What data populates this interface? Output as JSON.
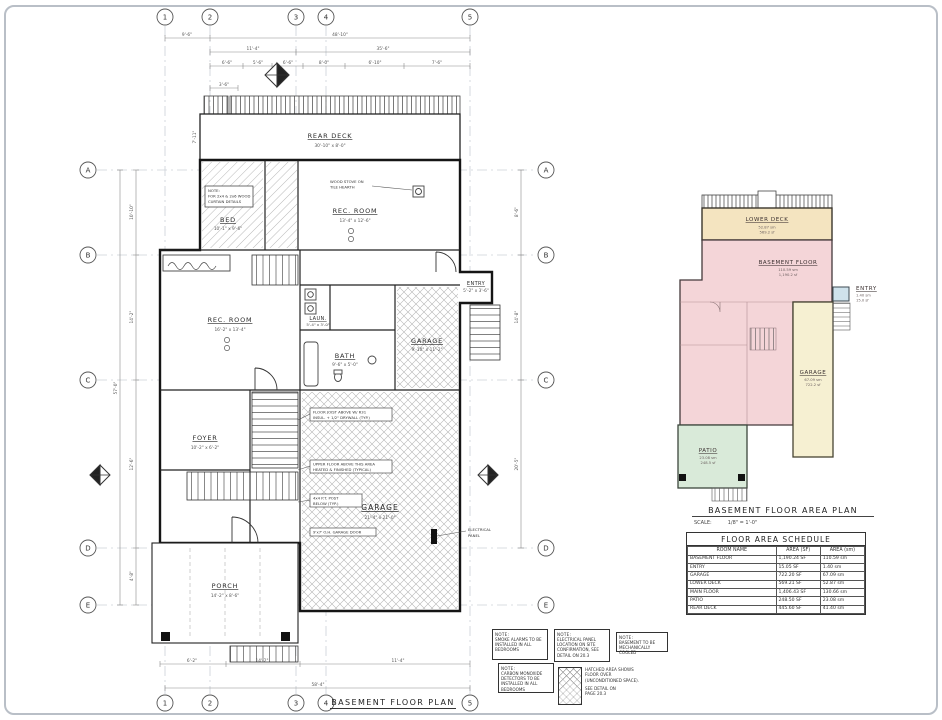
{
  "sheet": {
    "main_title": "BASEMENT FLOOR PLAN",
    "grid_cols": [
      "1",
      "2",
      "3",
      "4",
      "5"
    ],
    "grid_rows": [
      "A",
      "B",
      "C",
      "D",
      "E"
    ]
  },
  "dims": {
    "top1a": "9'-6\"",
    "top1b": "48'-10\"",
    "top2a": "11'-4\"",
    "top2b": "35'-6\"",
    "top3": [
      "6'-6\"",
      "5'-6\"",
      "6'-6\"",
      "8'-0\"",
      "6'-10\"",
      "7'-6\""
    ],
    "small_top": "3'-6\"",
    "deck_left": "7'-11\"",
    "left_overall": "57'-0\"",
    "left_segs": [
      "10'-10\"",
      "14'-2\"",
      "12'-6\"",
      "4'-8\""
    ],
    "right_segs": [
      "8'-6\"",
      "14'-8\"",
      "20'-5\""
    ],
    "bottom_segs": [
      "6'-2\"",
      "14'-2\"",
      "11'-4\""
    ],
    "bottom_overall": "58'-4\""
  },
  "rooms": {
    "rear_deck": {
      "name": "REAR DECK",
      "dim": "30'-10\" x 8'-0\""
    },
    "bed": {
      "name": "BED",
      "dim": "10'-1\" x 9'-6\""
    },
    "rec_upper": {
      "name": "REC. ROOM",
      "dim": "13'-4\" x 12'-6\""
    },
    "rec_lower": {
      "name": "REC. ROOM",
      "dim": "16'-2\" x 13'-4\""
    },
    "garage_upper": {
      "name": "GARAGE",
      "dim": "9'-10\" x 11'-2\""
    },
    "entry": {
      "name": "ENTRY",
      "dim": "5'-2\" x 3'-6\""
    },
    "laundry": {
      "name": "LAUN.",
      "dim": "5'-4\" x 3'-0\""
    },
    "bath": {
      "name": "BATH",
      "dim": "9'-6\" x 5'-0\""
    },
    "foyer": {
      "name": "FOYER",
      "dim": "10'-2\" x 6'-2\""
    },
    "garage_lower": {
      "name": "GARAGE",
      "dim": "21'-4\" x 21'-0\""
    },
    "porch": {
      "name": "PORCH",
      "dim": "14'-2\" x 8'-6\""
    }
  },
  "callouts": {
    "electrical_panel": [
      "ELECTRICAL",
      "PANEL"
    ],
    "bed_note": [
      "NOTE:",
      "FOR 2x4 & 2x6 WOOD",
      "CURTAIN DETAILS"
    ],
    "stove_note": [
      "WOOD STOVE ON",
      "TILE HEARTH"
    ],
    "joist_note": [
      "FLOOR JOIST ABOVE W/ R31",
      "INSUL. + 1/2\" DRYWALL (TYP.)"
    ],
    "overhang_note": [
      "UPPER FLOOR ABOVE THIS AREA",
      "HEATED & FINISHED (TYPICAL)"
    ],
    "post_note": [
      "4x4 P.T. POST",
      "BELOW (TYP.)"
    ],
    "garage_door_note": "9'x7' O.H. GARAGE DOOR"
  },
  "area_plan": {
    "title": "BASEMENT FLOOR AREA PLAN",
    "scale_label": "SCALE:",
    "scale_value": "1/8\" = 1'-0\"",
    "regions": {
      "lower_deck": {
        "name": "LOWER DECK",
        "metric": "52.87 sm",
        "imperial": "569.2 sf",
        "color": "#f4e4c0"
      },
      "basement": {
        "name": "BASEMENT FLOOR",
        "metric": "110.59 sm",
        "imperial": "1,190.2 sf",
        "color": "#f4d5d8"
      },
      "entry": {
        "name": "ENTRY",
        "metric": "1.40 sm",
        "imperial": "15.0 sf",
        "color": "#cfe2ec"
      },
      "garage": {
        "name": "GARAGE",
        "metric": "67.09 sm",
        "imperial": "722.2 sf",
        "color": "#f6f0d2"
      },
      "patio": {
        "name": "PATIO",
        "metric": "23.08 sm",
        "imperial": "248.5 sf",
        "color": "#d9ead9"
      }
    }
  },
  "schedule": {
    "title": "FLOOR AREA SCHEDULE",
    "columns": [
      "ROOM NAME",
      "AREA (SF)",
      "AREA (sm)"
    ],
    "rows": [
      [
        "BASEMENT FLOOR",
        "1,190.24 SF",
        "110.59 sm"
      ],
      [
        "ENTRY",
        "15.05 SF",
        "1.40 sm"
      ],
      [
        "GARAGE",
        "722.20 SF",
        "67.09 sm"
      ],
      [
        "LOWER DECK",
        "569.21 SF",
        "52.87 sm"
      ],
      [
        "MAIN FLOOR",
        "1,406.43 SF",
        "130.66 sm"
      ],
      [
        "PATIO",
        "248.50 SF",
        "23.08 sm"
      ],
      [
        "REAR DECK",
        "445.60 SF",
        "41.40 sm"
      ]
    ]
  },
  "notes": {
    "n1": {
      "title": "NOTE:",
      "lines": [
        "SMOKE ALARMS TO BE",
        "INSTALLED IN ALL",
        "BEDROOMS"
      ]
    },
    "n2": {
      "title": "NOTE:",
      "lines": [
        "ELECTRICAL PANEL",
        "LOCATION ON SITE",
        "CONFIRMATION, SEE",
        "DETAIL ON 20.3"
      ]
    },
    "n3": {
      "title": "NOTE:",
      "lines": [
        "BASEMENT TO BE",
        "MECHANICALLY COOLED"
      ]
    },
    "n4": {
      "title": "NOTE:",
      "lines": [
        "CARBON MONOXIDE",
        "DETECTORS TO BE",
        "INSTALLED IN ALL",
        "BEDROOMS"
      ]
    },
    "legend": {
      "lines": [
        "HATCHED AREA SHOWS",
        "FLOOR OVER",
        "(UNCONDITIONED SPACE).",
        "SEE DETAIL ON",
        "PAGE 20.3"
      ]
    }
  }
}
